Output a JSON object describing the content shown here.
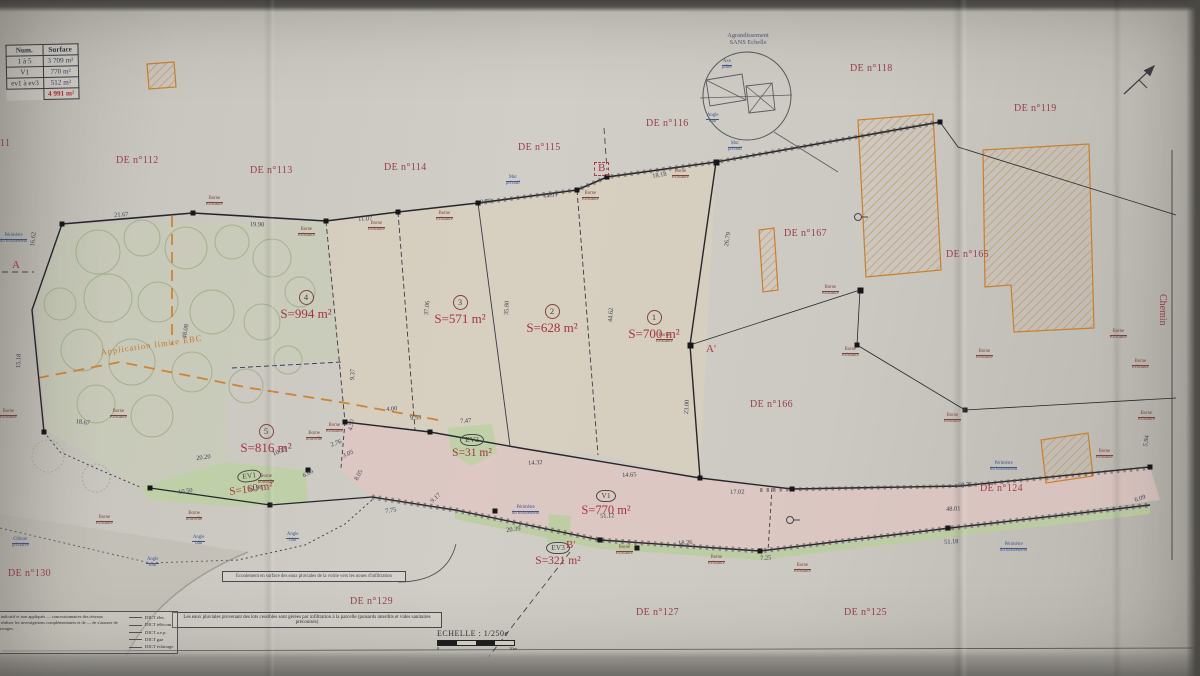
{
  "colors": {
    "maroon": "#97404b",
    "area_red": "#a43441",
    "blue": "#42568c",
    "orange": "#c9853a",
    "dim": "#3e4356",
    "road_pink": "#decdc9",
    "ev_green": "#c2d0a9",
    "paper": "#ccc9c2"
  },
  "table": {
    "headers": [
      "Num.",
      "Surface"
    ],
    "rows": [
      [
        "1 à 5",
        "3 709 m²"
      ],
      [
        "V1",
        "770 m²"
      ],
      [
        "ev1 à ev3",
        "512 m²"
      ]
    ],
    "total": "4 991 m²"
  },
  "detail_circle": {
    "title_line1": "Agrandissement",
    "title_line2": "SANS Echelle",
    "label_top1": "Axe",
    "label_top2": "pilier",
    "label_bottom1": "Angle",
    "label_bottom2": "mur"
  },
  "scale": {
    "title": "ECHELLE : 1/250e",
    "min": "0",
    "max": "10m"
  },
  "chemin": "Chemin",
  "ebc_label": "Application limite EBC",
  "notes": {
    "note1": "Ecoulement en surface des eaux pluviales de la voirie vers les noues d'infiltration",
    "note2": "Les eaux pluviales provenant des lots cessibles sont gérées par infiltration à la parcelle (puisards interdits et vides sanitaires préconisés)"
  },
  "dict": {
    "paragraph": "réseaux sont donnés à titre indicatif et non appliqués — concessionnaires des réseaux concernés (classe de — de réaliser les investigations complémentaires et de — de s'assurer de l'emplacement exact des ouvrages.",
    "items": [
      "DICT élec.",
      "DICT télécom.",
      "DICT a.e.p.",
      "DICT gaz",
      "DICT éclairage"
    ]
  },
  "parcels": [
    {
      "badge": "4",
      "shape": "c",
      "area": "S=994 m²",
      "x": 268,
      "y": 288,
      "fs": 13
    },
    {
      "badge": "3",
      "shape": "c",
      "area": "S=571 m²",
      "x": 422,
      "y": 293,
      "fs": 13
    },
    {
      "badge": "2",
      "shape": "c",
      "area": "S=628 m²",
      "x": 514,
      "y": 302,
      "fs": 13
    },
    {
      "badge": "1",
      "shape": "c",
      "area": "S=700 m²",
      "x": 616,
      "y": 308,
      "fs": 13
    },
    {
      "badge": "5",
      "shape": "c",
      "area": "S=816 m²",
      "x": 228,
      "y": 422,
      "fs": 13
    },
    {
      "badge": "V1",
      "shape": "o",
      "area": "S=770 m²",
      "x": 568,
      "y": 487,
      "fs": 12.5
    },
    {
      "badge": "EV1",
      "shape": "o",
      "area": "S=160 m²",
      "x": 212,
      "y": 469,
      "fs": 11,
      "r": -8
    },
    {
      "badge": "EV2",
      "shape": "o",
      "area": "S=31 m²",
      "x": 434,
      "y": 433,
      "fs": 11.5
    },
    {
      "badge": "EV3",
      "shape": "o",
      "area": "S=321 m²",
      "x": 520,
      "y": 541,
      "fs": 11.5
    }
  ],
  "de_labels": [
    {
      "t": "11",
      "x": 0,
      "y": 139
    },
    {
      "t": "DE n°112",
      "x": 116,
      "y": 156
    },
    {
      "t": "DE n°113",
      "x": 250,
      "y": 166
    },
    {
      "t": "DE n°114",
      "x": 384,
      "y": 163
    },
    {
      "t": "DE n°115",
      "x": 518,
      "y": 143
    },
    {
      "t": "DE n°116",
      "x": 646,
      "y": 119
    },
    {
      "t": "DE n°118",
      "x": 850,
      "y": 64
    },
    {
      "t": "DE n°119",
      "x": 1014,
      "y": 104
    },
    {
      "t": "DE n°167",
      "x": 784,
      "y": 229
    },
    {
      "t": "DE n°165",
      "x": 946,
      "y": 250
    },
    {
      "t": "DE n°166",
      "x": 750,
      "y": 400
    },
    {
      "t": "DE n°124",
      "x": 980,
      "y": 484
    },
    {
      "t": "DE n°125",
      "x": 844,
      "y": 608
    },
    {
      "t": "DE n°127",
      "x": 636,
      "y": 608
    },
    {
      "t": "DE n°129",
      "x": 350,
      "y": 597
    },
    {
      "t": "DE n°130",
      "x": 8,
      "y": 569
    }
  ],
  "sections": [
    {
      "t": "A",
      "x": 12,
      "y": 260
    },
    {
      "t": "A'",
      "x": 706,
      "y": 344
    },
    {
      "t": "B",
      "x": 594,
      "y": 162,
      "c": "boxed"
    },
    {
      "t": "B'",
      "x": 566,
      "y": 540
    }
  ],
  "dimensions": [
    {
      "t": "21.67",
      "x": 114,
      "y": 213,
      "r": -4
    },
    {
      "t": "19.90",
      "x": 250,
      "y": 222,
      "r": 2
    },
    {
      "t": "11.07",
      "x": 358,
      "y": 217,
      "r": -4
    },
    {
      "t": "9.75",
      "x": 480,
      "y": 200,
      "r": -6
    },
    {
      "t": "14.91",
      "x": 543,
      "y": 194,
      "r": -7
    },
    {
      "t": "18.18",
      "x": 652,
      "y": 174,
      "r": -9
    },
    {
      "t": "16.62",
      "x": 30,
      "y": 246,
      "r": -83
    },
    {
      "t": "15.18",
      "x": 16,
      "y": 368,
      "r": -87
    },
    {
      "t": "48.08",
      "x": 182,
      "y": 338,
      "r": -80
    },
    {
      "t": "37.06",
      "x": 424,
      "y": 315,
      "r": -84
    },
    {
      "t": "35.80",
      "x": 504,
      "y": 315,
      "r": -86
    },
    {
      "t": "44.62",
      "x": 608,
      "y": 322,
      "r": -86
    },
    {
      "t": "26.79",
      "x": 724,
      "y": 246,
      "r": -80
    },
    {
      "t": "23.00",
      "x": 684,
      "y": 414,
      "r": -86
    },
    {
      "t": "18.67",
      "x": 76,
      "y": 419,
      "r": 8
    },
    {
      "t": "20.20",
      "x": 196,
      "y": 456,
      "r": -7
    },
    {
      "t": "10.50",
      "x": 178,
      "y": 490,
      "r": -8
    },
    {
      "t": "10.33",
      "x": 272,
      "y": 452,
      "r": -22
    },
    {
      "t": "12.98",
      "x": 248,
      "y": 487,
      "r": -9
    },
    {
      "t": "9.53",
      "x": 410,
      "y": 416,
      "r": -5
    },
    {
      "t": "7.47",
      "x": 460,
      "y": 419,
      "r": -4
    },
    {
      "t": "14.32",
      "x": 528,
      "y": 461,
      "r": -4
    },
    {
      "t": "14.65",
      "x": 622,
      "y": 473,
      "r": -3
    },
    {
      "t": "17.02",
      "x": 730,
      "y": 490,
      "r": -2
    },
    {
      "t": "60.75",
      "x": 958,
      "y": 483,
      "r": -3
    },
    {
      "t": "48.01",
      "x": 946,
      "y": 507,
      "r": -3
    },
    {
      "t": "51.12",
      "x": 600,
      "y": 514,
      "r": -3
    },
    {
      "t": "20.39",
      "x": 506,
      "y": 528,
      "r": -7
    },
    {
      "t": "18.26",
      "x": 678,
      "y": 541,
      "r": -4
    },
    {
      "t": "7.25",
      "x": 760,
      "y": 556,
      "r": -3
    },
    {
      "t": "51.18",
      "x": 944,
      "y": 540,
      "r": -4
    },
    {
      "t": "7.75",
      "x": 385,
      "y": 509,
      "r": -9
    },
    {
      "t": "9.17",
      "x": 430,
      "y": 500,
      "r": -42
    },
    {
      "t": "4.00",
      "x": 386,
      "y": 407,
      "r": -5
    },
    {
      "t": "4.50",
      "x": 348,
      "y": 430,
      "r": -80
    },
    {
      "t": "9.37",
      "x": 350,
      "y": 380,
      "r": -86
    },
    {
      "t": "6.06",
      "x": 302,
      "y": 474,
      "r": -27
    },
    {
      "t": "2.76",
      "x": 330,
      "y": 443,
      "r": -20
    },
    {
      "t": "3.05",
      "x": 342,
      "y": 454,
      "r": -24
    },
    {
      "t": "8.05",
      "x": 354,
      "y": 479,
      "r": -62
    },
    {
      "t": "5.94",
      "x": 1143,
      "y": 446,
      "r": -80
    },
    {
      "t": "6.09",
      "x": 1134,
      "y": 498,
      "r": -18
    }
  ],
  "tiny_labels": [
    {
      "l1": "Borne",
      "l2": "existante",
      "x": 206,
      "y": 197,
      "c": "m"
    },
    {
      "l1": "Borne",
      "l2": "existante",
      "x": 298,
      "y": 228,
      "c": "m"
    },
    {
      "l1": "Borne",
      "l2": "existante",
      "x": 368,
      "y": 222,
      "c": "m"
    },
    {
      "l1": "Borne",
      "l2": "existante",
      "x": 436,
      "y": 212,
      "c": "m"
    },
    {
      "l1": "Borne",
      "l2": "existante",
      "x": 582,
      "y": 192,
      "c": "m"
    },
    {
      "l1": "Borne",
      "l2": "existante",
      "x": 672,
      "y": 170,
      "c": "m"
    },
    {
      "l1": "Borne",
      "l2": "existante",
      "x": 656,
      "y": 334,
      "c": "m"
    },
    {
      "l1": "Borne",
      "l2": "existante",
      "x": 822,
      "y": 286,
      "c": "m"
    },
    {
      "l1": "Borne",
      "l2": "existante",
      "x": 842,
      "y": 348,
      "c": "m"
    },
    {
      "l1": "Borne",
      "l2": "existante",
      "x": 944,
      "y": 414,
      "c": "m"
    },
    {
      "l1": "Borne",
      "l2": "existante",
      "x": 976,
      "y": 350,
      "c": "m"
    },
    {
      "l1": "Borne",
      "l2": "existante",
      "x": 1110,
      "y": 330,
      "c": "m"
    },
    {
      "l1": "Borne",
      "l2": "existante",
      "x": 1132,
      "y": 360,
      "c": "m"
    },
    {
      "l1": "Borne",
      "l2": "existante",
      "x": 1138,
      "y": 412,
      "c": "m"
    },
    {
      "l1": "Borne",
      "l2": "existante",
      "x": 1096,
      "y": 450,
      "c": "m"
    },
    {
      "l1": "Borne",
      "l2": "existante",
      "x": 326,
      "y": 424,
      "c": "m"
    },
    {
      "l1": "Borne",
      "l2": "existante",
      "x": 96,
      "y": 516,
      "c": "m"
    },
    {
      "l1": "Borne",
      "l2": "existante",
      "x": 110,
      "y": 410,
      "c": "m"
    },
    {
      "l1": "Borne",
      "l2": "existante",
      "x": 0,
      "y": 410,
      "c": "m"
    },
    {
      "l1": "Borne",
      "l2": "existante",
      "x": 616,
      "y": 546,
      "c": "m"
    },
    {
      "l1": "Borne",
      "l2": "existante",
      "x": 708,
      "y": 556,
      "c": "m"
    },
    {
      "l1": "Borne",
      "l2": "existante",
      "x": 794,
      "y": 564,
      "c": "m"
    },
    {
      "l1": "Borne",
      "l2": "nouvelle",
      "x": 258,
      "y": 475,
      "c": "m"
    },
    {
      "l1": "Borne",
      "l2": "nouvelle",
      "x": 186,
      "y": 512,
      "c": "m"
    },
    {
      "l1": "Borne",
      "l2": "nouvelle",
      "x": 306,
      "y": 432,
      "c": "m"
    },
    {
      "l1": "Mur",
      "l2": "privatif",
      "x": 506,
      "y": 176,
      "c": "b"
    },
    {
      "l1": "Mur",
      "l2": "privatif",
      "x": 728,
      "y": 142,
      "c": "b"
    },
    {
      "l1": "Périmètre",
      "l2": "du lotissement",
      "x": 0,
      "y": 234,
      "c": "b"
    },
    {
      "l1": "Périmètre",
      "l2": "du lotissement",
      "x": 512,
      "y": 506,
      "c": "b"
    },
    {
      "l1": "Périmètre",
      "l2": "du lotissement",
      "x": 990,
      "y": 462,
      "c": "b"
    },
    {
      "l1": "Périmètre",
      "l2": "du lotissement",
      "x": 1000,
      "y": 543,
      "c": "b"
    },
    {
      "l1": "Clôture",
      "l2": "privative",
      "x": 12,
      "y": 538,
      "c": "b"
    },
    {
      "l1": "Angle",
      "l2": "bâti",
      "x": 192,
      "y": 536,
      "c": "b"
    },
    {
      "l1": "Angle",
      "l2": "bâti",
      "x": 286,
      "y": 533,
      "c": "b"
    },
    {
      "l1": "Angle",
      "l2": "mur",
      "x": 146,
      "y": 558,
      "c": "b"
    }
  ]
}
